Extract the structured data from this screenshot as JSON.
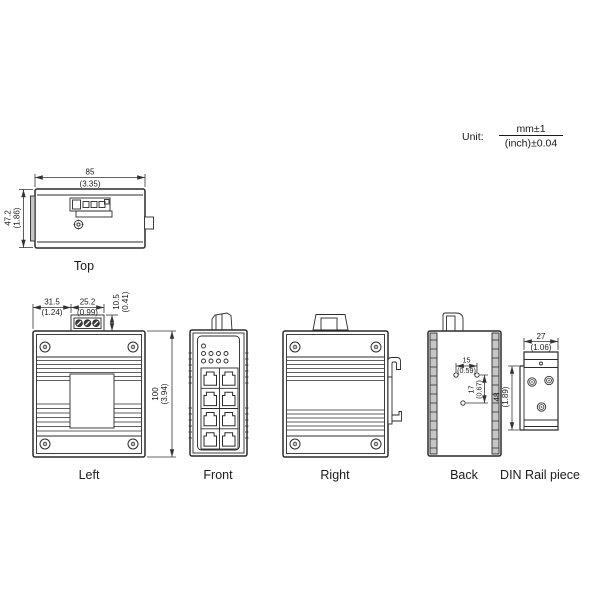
{
  "unit": {
    "prefix": "Unit:",
    "mm": "mm±1",
    "inch": "(inch)±0.04"
  },
  "top_view": {
    "label": "Top",
    "width_mm": "85",
    "width_in": "(3.35)",
    "depth_mm": "47.2",
    "depth_in": "(1.86)"
  },
  "left_view": {
    "label": "Left",
    "offset_mm": "31.5",
    "offset_in": "(1.24)",
    "terminal_mm": "25.2",
    "terminal_in": "(0.99)",
    "terminal_h_mm": "10.5",
    "terminal_h_in": "(0.41)",
    "height_mm": "100",
    "height_in": "(3.94)"
  },
  "front_view": {
    "label": "Front"
  },
  "right_view": {
    "label": "Right"
  },
  "back_view": {
    "label": "Back",
    "hole_mm": "15",
    "hole_in": "(0.59)",
    "pitch_mm": "17",
    "pitch_in": "(0.67)"
  },
  "din_view": {
    "label": "DIN Rail piece",
    "width_mm": "27",
    "width_in": "(1.06)",
    "height_mm": "48",
    "height_in": "(1.89)"
  }
}
